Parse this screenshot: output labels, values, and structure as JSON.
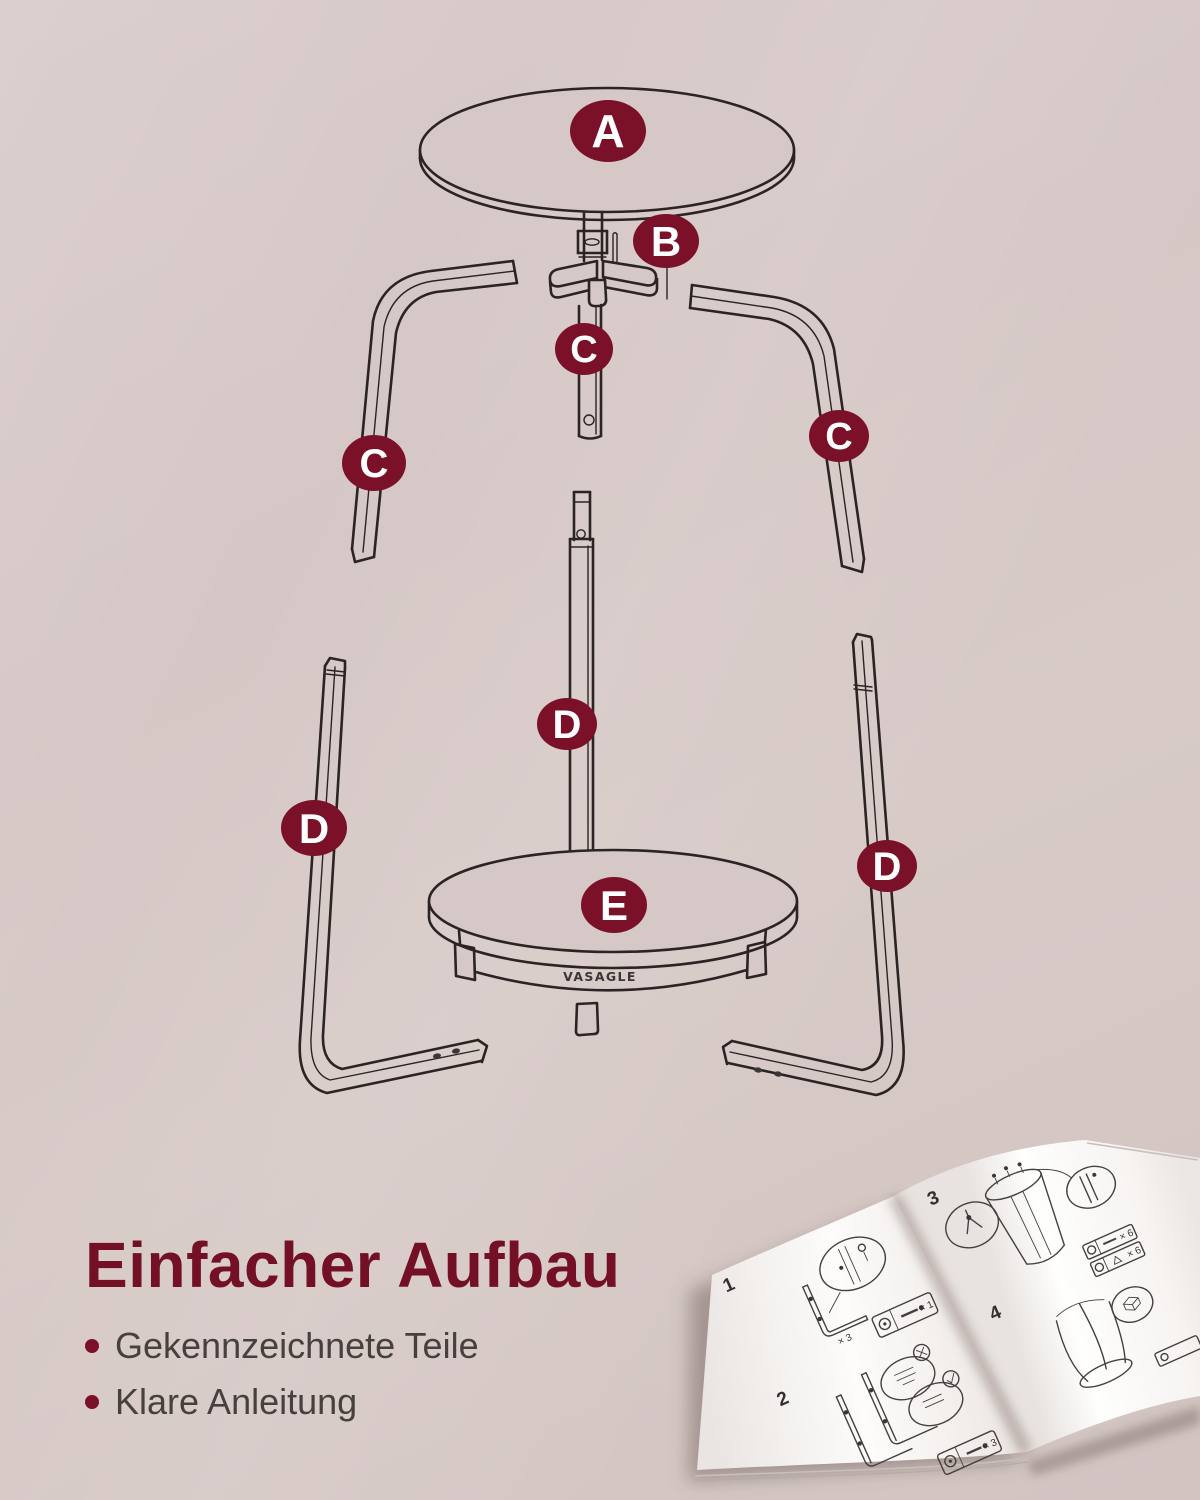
{
  "image": {
    "width": 1200,
    "height": 1500,
    "kind": "exploded-assembly-product-graphic"
  },
  "colors": {
    "background": "#d5c7c5",
    "badge": "#7a1128",
    "heading": "#731026",
    "body_text": "#47403f",
    "line_art": "#2b2324",
    "page": "#fbfaf8"
  },
  "diagram": {
    "badges": [
      {
        "part": "tabletop",
        "letter": "A"
      },
      {
        "part": "connector-hub",
        "letter": "B"
      },
      {
        "part": "upper-leg-left",
        "letter": "C"
      },
      {
        "part": "upper-pole",
        "letter": "C"
      },
      {
        "part": "upper-leg-right",
        "letter": "C"
      },
      {
        "part": "lower-leg-left",
        "letter": "D"
      },
      {
        "part": "lower-pole",
        "letter": "D"
      },
      {
        "part": "lower-leg-right",
        "letter": "D"
      },
      {
        "part": "shelf",
        "letter": "E"
      }
    ],
    "brand": "VASAGLE"
  },
  "caption": {
    "heading": "Einfacher Aufbau",
    "bullets": [
      "Gekennzeichnete Teile",
      "Klare Anleitung"
    ]
  },
  "booklet": {
    "steps": [
      "1",
      "2",
      "3",
      "4"
    ],
    "quantities": [
      "× 3",
      "× 1",
      "× 3",
      "× 6",
      "× 6"
    ]
  }
}
